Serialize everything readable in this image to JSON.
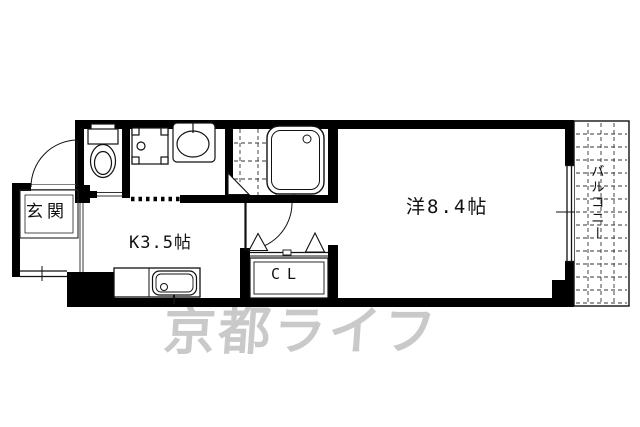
{
  "floor_plan": {
    "rooms": {
      "entrance": {
        "label": "玄関"
      },
      "kitchen": {
        "label": "K3.5帖"
      },
      "closet": {
        "label": "CL"
      },
      "main_room": {
        "label": "洋8.4帖"
      },
      "balcony": {
        "label": "バルコニー"
      }
    },
    "fixtures": [
      "toilet",
      "washing-machine-pan",
      "washbasin",
      "bathtub",
      "kitchen-sink"
    ],
    "watermark": {
      "text": "京都ライフ",
      "color": "#c9c9c9"
    },
    "colors": {
      "walls": "#000000",
      "lines": "#1a1a1a",
      "background": "#ffffff"
    }
  }
}
